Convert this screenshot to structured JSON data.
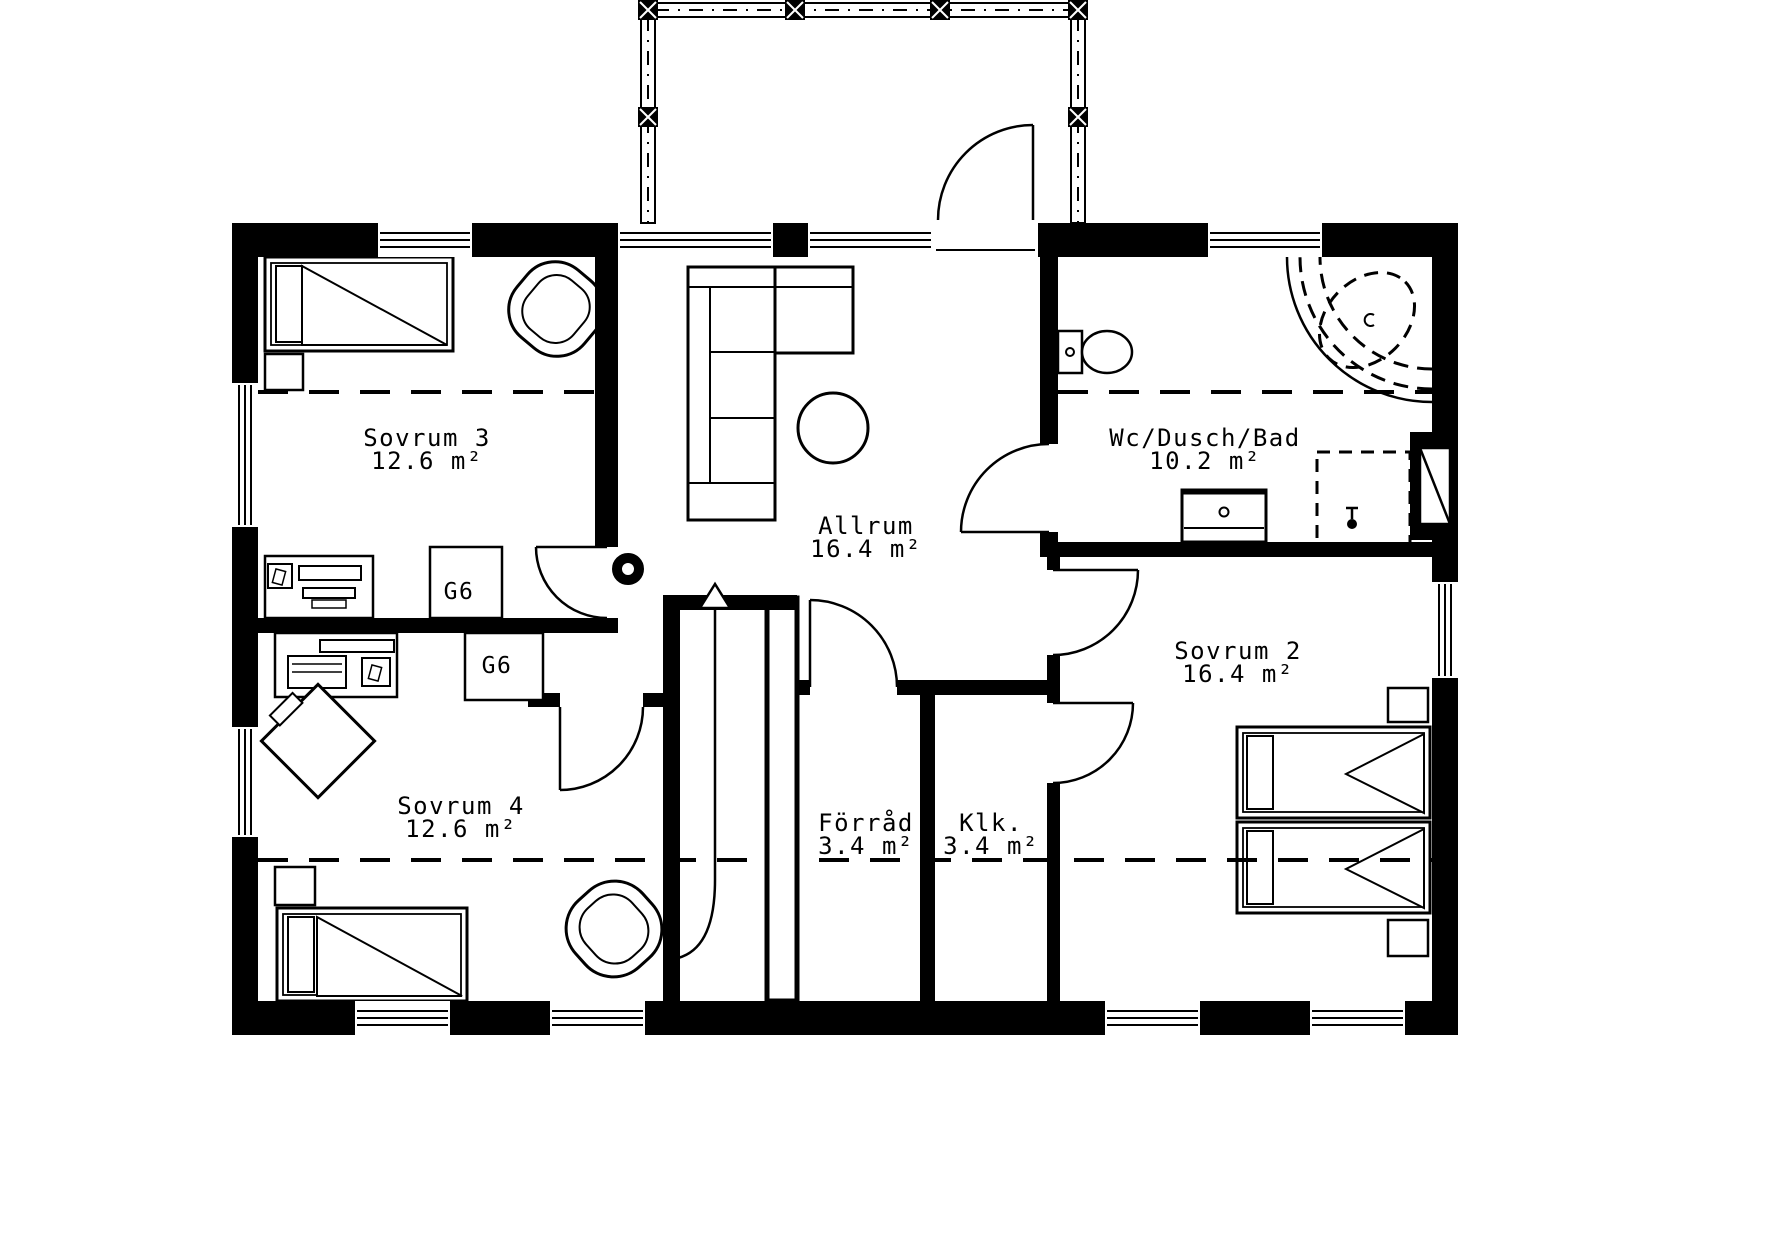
{
  "rooms": {
    "sovrum3": {
      "name": "Sovrum 3",
      "area": "12.6 m²"
    },
    "sovrum4": {
      "name": "Sovrum 4",
      "area": "12.6 m²"
    },
    "allrum": {
      "name": "Allrum",
      "area": "16.4 m²"
    },
    "badrum": {
      "name": "Wc/Dusch/Bad",
      "area": "10.2 m²"
    },
    "sovrum2": {
      "name": "Sovrum 2",
      "area": "16.4 m²"
    },
    "forrad": {
      "name": "Förråd",
      "area": "3.4 m²"
    },
    "klk": {
      "name": "Klk.",
      "area": "3.4 m²"
    }
  },
  "wardrobe_label": "G6",
  "colors": {
    "wall": "#000000",
    "floor": "#ffffff",
    "line": "#000000"
  }
}
